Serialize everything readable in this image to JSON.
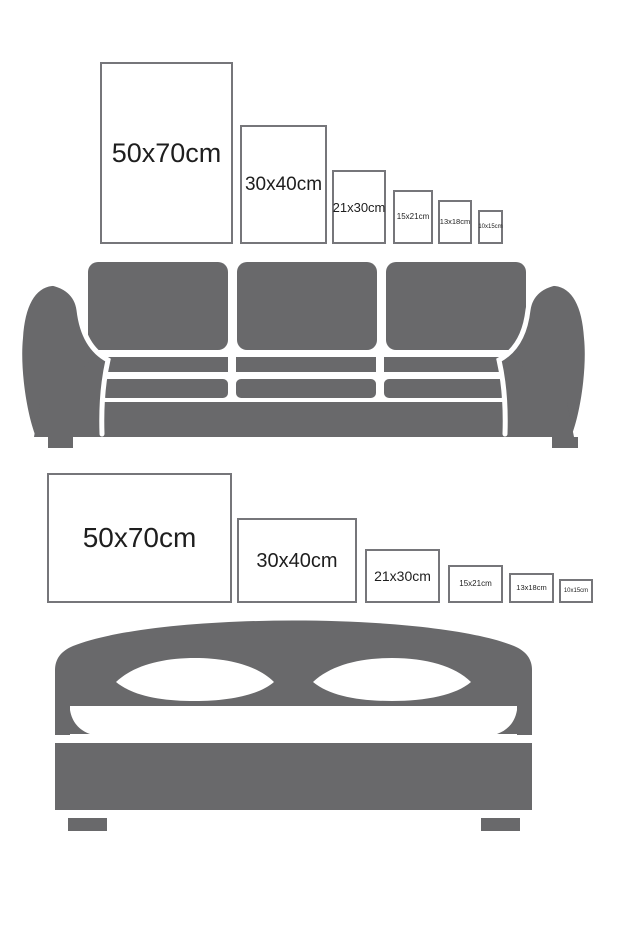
{
  "colors": {
    "furniture": "#69696b",
    "frame_border": "#76767a",
    "text": "#1e1e1e",
    "background": "#ffffff"
  },
  "sofa_section": {
    "name": "poster sizes above sofa",
    "furniture": "sofa",
    "frames": [
      {
        "label": "50x70cm",
        "left": 100,
        "top": 62,
        "width": 133,
        "height": 182,
        "font_size": 27
      },
      {
        "label": "30x40cm",
        "left": 240,
        "top": 125,
        "width": 87,
        "height": 119,
        "font_size": 19
      },
      {
        "label": "21x30cm",
        "left": 332,
        "top": 170,
        "width": 54,
        "height": 74,
        "font_size": 13
      },
      {
        "label": "15x21cm",
        "left": 393,
        "top": 190,
        "width": 40,
        "height": 54,
        "font_size": 8
      },
      {
        "label": "13x18cm",
        "left": 438,
        "top": 200,
        "width": 34,
        "height": 44,
        "font_size": 7.5
      },
      {
        "label": "10x15cm",
        "left": 478,
        "top": 210,
        "width": 25,
        "height": 34,
        "font_size": 6
      }
    ]
  },
  "bed_section": {
    "name": "poster sizes above bed",
    "furniture": "bed",
    "frames": [
      {
        "label": "50x70cm",
        "left": 47,
        "top": 473,
        "width": 185,
        "height": 130,
        "font_size": 28
      },
      {
        "label": "30x40cm",
        "left": 237,
        "top": 518,
        "width": 120,
        "height": 85,
        "font_size": 20
      },
      {
        "label": "21x30cm",
        "left": 365,
        "top": 549,
        "width": 75,
        "height": 54,
        "font_size": 14
      },
      {
        "label": "15x21cm",
        "left": 448,
        "top": 565,
        "width": 55,
        "height": 38,
        "font_size": 8
      },
      {
        "label": "13x18cm",
        "left": 509,
        "top": 573,
        "width": 45,
        "height": 30,
        "font_size": 7.5
      },
      {
        "label": "10x15cm",
        "left": 559,
        "top": 579,
        "width": 34,
        "height": 24,
        "font_size": 6
      }
    ]
  }
}
